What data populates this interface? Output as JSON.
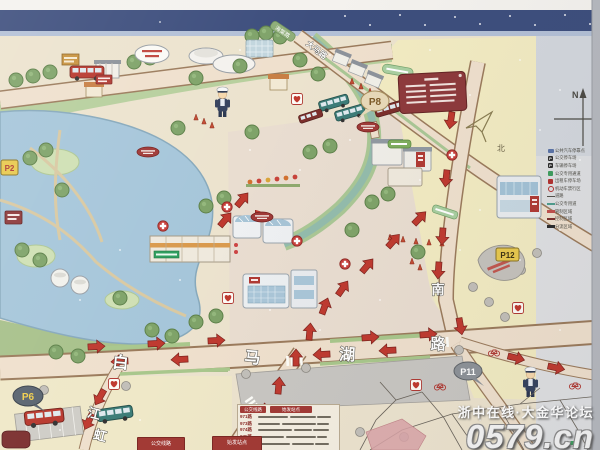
{
  "watermark": {
    "line1": "浙中在线·大金华论坛",
    "line2": "0579.cn"
  },
  "compass": {
    "n": "N",
    "north": "北"
  },
  "roads": {
    "main": {
      "name": "白马湖路",
      "chars": [
        "白",
        "马",
        "湖",
        "路"
      ]
    },
    "south": {
      "name": "南路",
      "chars": [
        "南",
        "路"
      ]
    },
    "southwest": {
      "name": "江虹路",
      "chars": [
        "江",
        "虹"
      ]
    },
    "top_diagonal": {
      "name": "大马路",
      "label": "大马路"
    },
    "top_sign": "海棠路"
  },
  "parking": {
    "p2": "P2",
    "p6": "P6",
    "p8": "P8",
    "p11": "P11",
    "p12": "P12"
  },
  "legend": {
    "items": [
      {
        "icon": "bus-stop-icon",
        "label": "公共汽车停靠点"
      },
      {
        "icon": "parking-bus-icon",
        "label": "公交停车场",
        "p": "P"
      },
      {
        "icon": "parking-car-icon",
        "label": "车辆停车场",
        "p": "P"
      },
      {
        "icon": "green-square-icon",
        "label": "公交专用通道"
      },
      {
        "icon": "taxi-square-icon",
        "label": "出租车停车场"
      },
      {
        "icon": "no-entry-icon",
        "label": "机动车禁行区"
      },
      {
        "icon": "thin-line-icon",
        "label": "道路"
      },
      {
        "icon": "teal-line-icon",
        "label": "公交专用道"
      },
      {
        "icon": "red-line-icon",
        "label": "管制区域"
      },
      {
        "icon": "maroon-line-icon",
        "label": "控制区域"
      },
      {
        "icon": "black-line-icon",
        "label": "分流区域"
      }
    ]
  },
  "bus_table": {
    "col1": "公交线路",
    "col2": "始发站点",
    "rows": [
      {
        "route": "971路"
      },
      {
        "route": "973路"
      },
      {
        "route": "974路"
      },
      {
        "route": "975路"
      },
      {
        "route": "975路"
      }
    ],
    "cut_header1": "公交线路",
    "cut_header2": "始发站点"
  },
  "colors": {
    "arrow": "#bf3a30",
    "navy_band": "#3d4e7d",
    "lake": "#a6c6da",
    "field": "#f2ebc2"
  }
}
